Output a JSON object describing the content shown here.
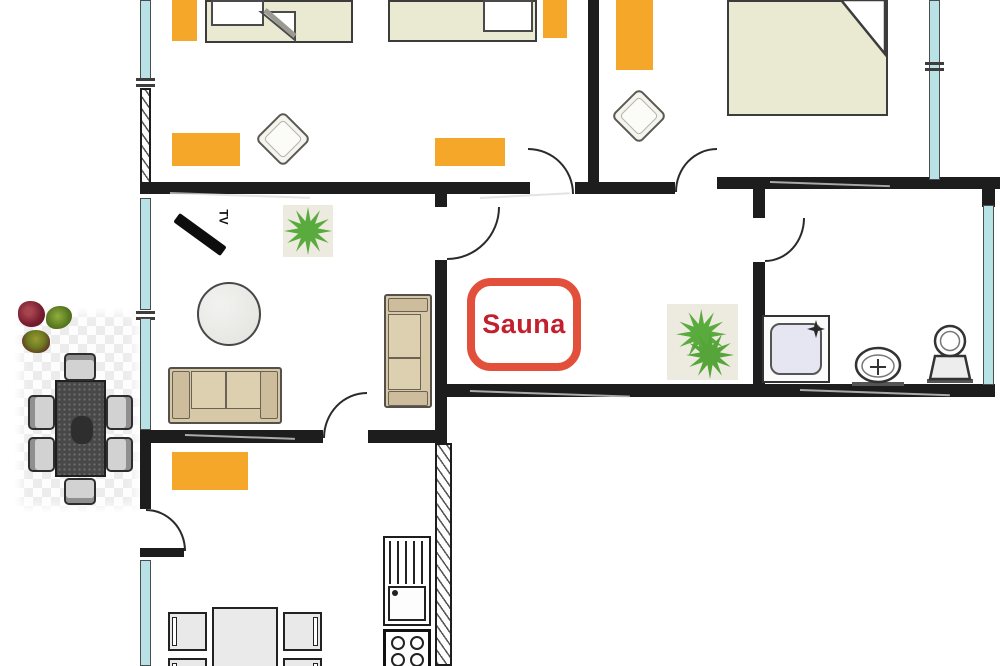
{
  "labels": {
    "sauna": "Sauna",
    "tv": "TV"
  },
  "colors": {
    "wall": "#1d1d1d",
    "window_glass": "#b9e2e6",
    "rug_orange": "#f5a72a",
    "bed_cream": "#eae9d2",
    "sofa_beige": "#d7c8a8",
    "plant_green": "#5aab3e",
    "sauna_border": "#e2503c",
    "sauna_text": "#c2202c",
    "shower_fill": "#e6e6f2",
    "terrace_table": "#484848"
  },
  "icons": [
    "bed-icon",
    "pillow-icon",
    "rug-icon",
    "pouf-icon",
    "plant-icon",
    "tv-icon",
    "sofa-icon",
    "armchair-icon",
    "round-table-icon",
    "shower-icon",
    "sink-icon",
    "toilet-icon",
    "dining-table-icon",
    "chair-icon",
    "kitchen-sink-icon",
    "stove-icon",
    "flowers-icon"
  ]
}
